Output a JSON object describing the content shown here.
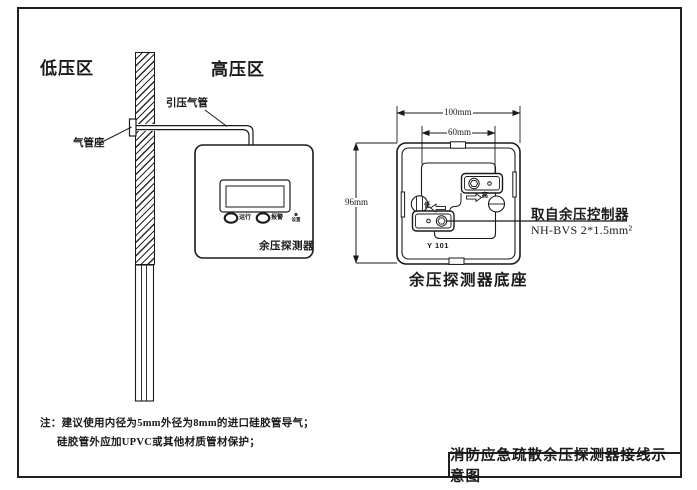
{
  "scene": {
    "zones": {
      "low": "低压区",
      "high": "高压区"
    },
    "pipe_label": "引压气管",
    "pipe_seat_label": "气管座"
  },
  "detector": {
    "name": "余压探测器",
    "indicators": {
      "run": "运行",
      "alarm": "报警",
      "set": "设置"
    }
  },
  "base": {
    "caption": "余压探测器底座",
    "model": "Y 101",
    "ports": {
      "high": "高",
      "low": "低"
    },
    "dimensions": {
      "width": "100mm",
      "inner_width": "60mm",
      "height": "96mm"
    },
    "wiring": {
      "source": "取自余压控制器",
      "cable": "NH-BVS 2*1.5mm²"
    }
  },
  "notes": {
    "prefix": "注：",
    "line1": "建议使用内径为5mm外径为8mm的进口硅胶管导气；",
    "line2": "硅胶管外应加UPVC或其他材质管材保护；"
  },
  "title_block": {
    "title": "消防应急疏散余压探测器接线示意图"
  },
  "colors": {
    "ink": "#1a1a1a",
    "background": "#ffffff"
  }
}
